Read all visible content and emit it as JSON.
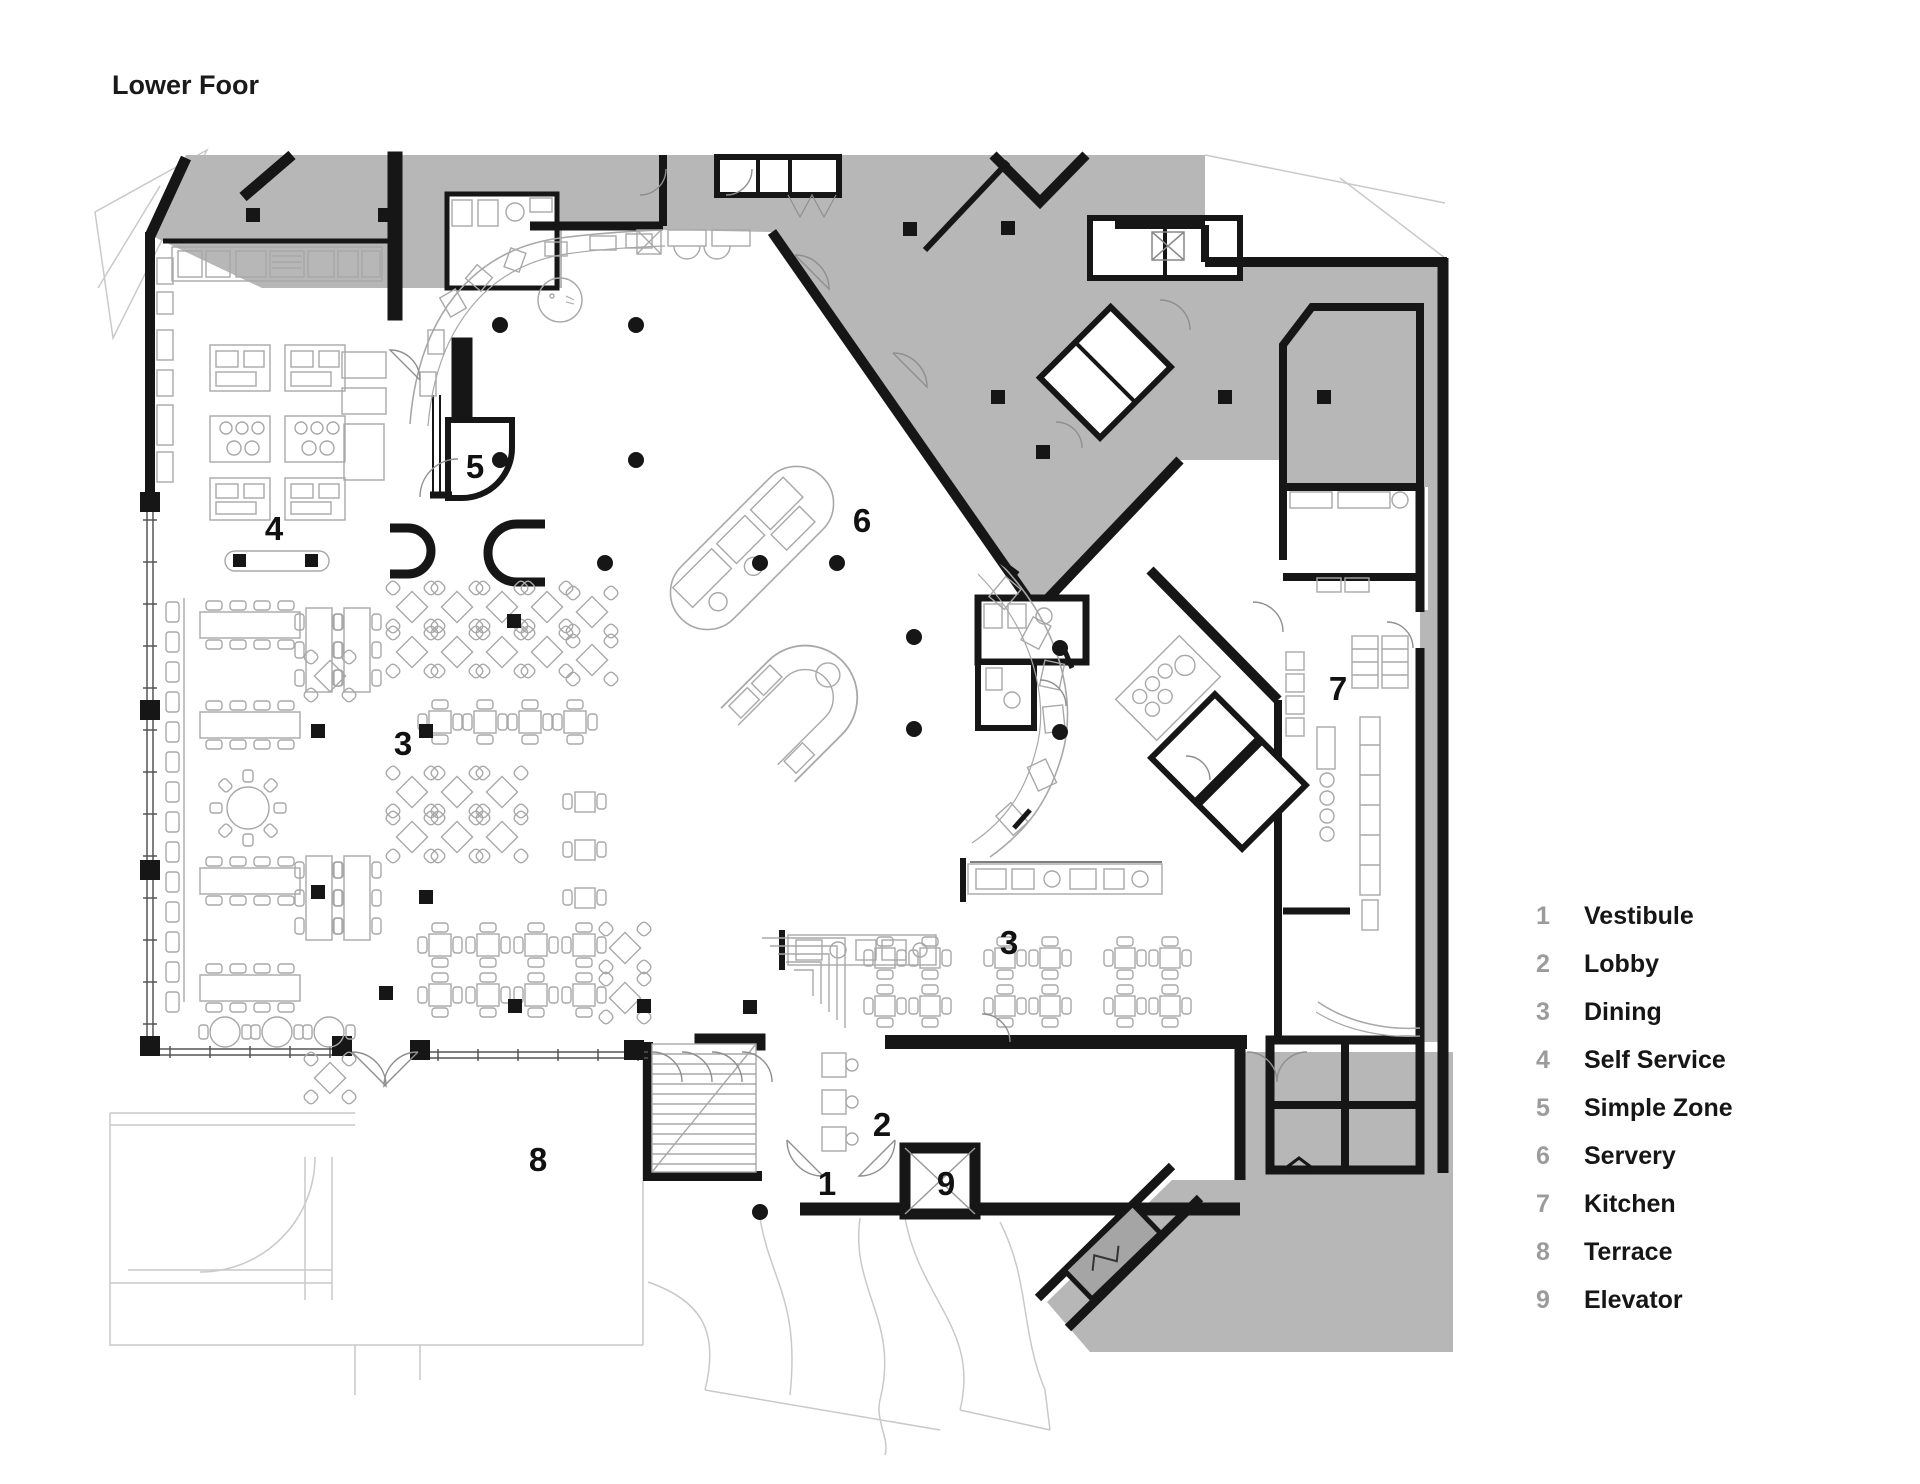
{
  "title": "Lower Foor",
  "colors": {
    "area_gray": "#b7b7b7",
    "wall_black": "#161616",
    "furniture_line": "#a8a8a8",
    "context_line": "#c9c9c9",
    "door_line": "#8f8f8f",
    "legend_number": "#9b9b9b",
    "text": "#1a1a1a"
  },
  "legend": {
    "items": [
      {
        "number": "1",
        "label": "Vestibule"
      },
      {
        "number": "2",
        "label": "Lobby"
      },
      {
        "number": "3",
        "label": "Dining"
      },
      {
        "number": "4",
        "label": "Self Service"
      },
      {
        "number": "5",
        "label": "Simple Zone"
      },
      {
        "number": "6",
        "label": "Servery"
      },
      {
        "number": "7",
        "label": "Kitchen"
      },
      {
        "number": "8",
        "label": "Terrace"
      },
      {
        "number": "9",
        "label": "Elevator"
      }
    ]
  },
  "plan_labels": [
    {
      "number": "4",
      "x": 274,
      "y": 540
    },
    {
      "number": "5",
      "x": 475,
      "y": 478
    },
    {
      "number": "6",
      "x": 862,
      "y": 532
    },
    {
      "number": "3",
      "x": 403,
      "y": 755
    },
    {
      "number": "7",
      "x": 1338,
      "y": 700
    },
    {
      "number": "3",
      "x": 1009,
      "y": 954
    },
    {
      "number": "8",
      "x": 538,
      "y": 1171
    },
    {
      "number": "2",
      "x": 882,
      "y": 1136
    },
    {
      "number": "1",
      "x": 827,
      "y": 1195
    },
    {
      "number": "9",
      "x": 946,
      "y": 1195
    }
  ]
}
